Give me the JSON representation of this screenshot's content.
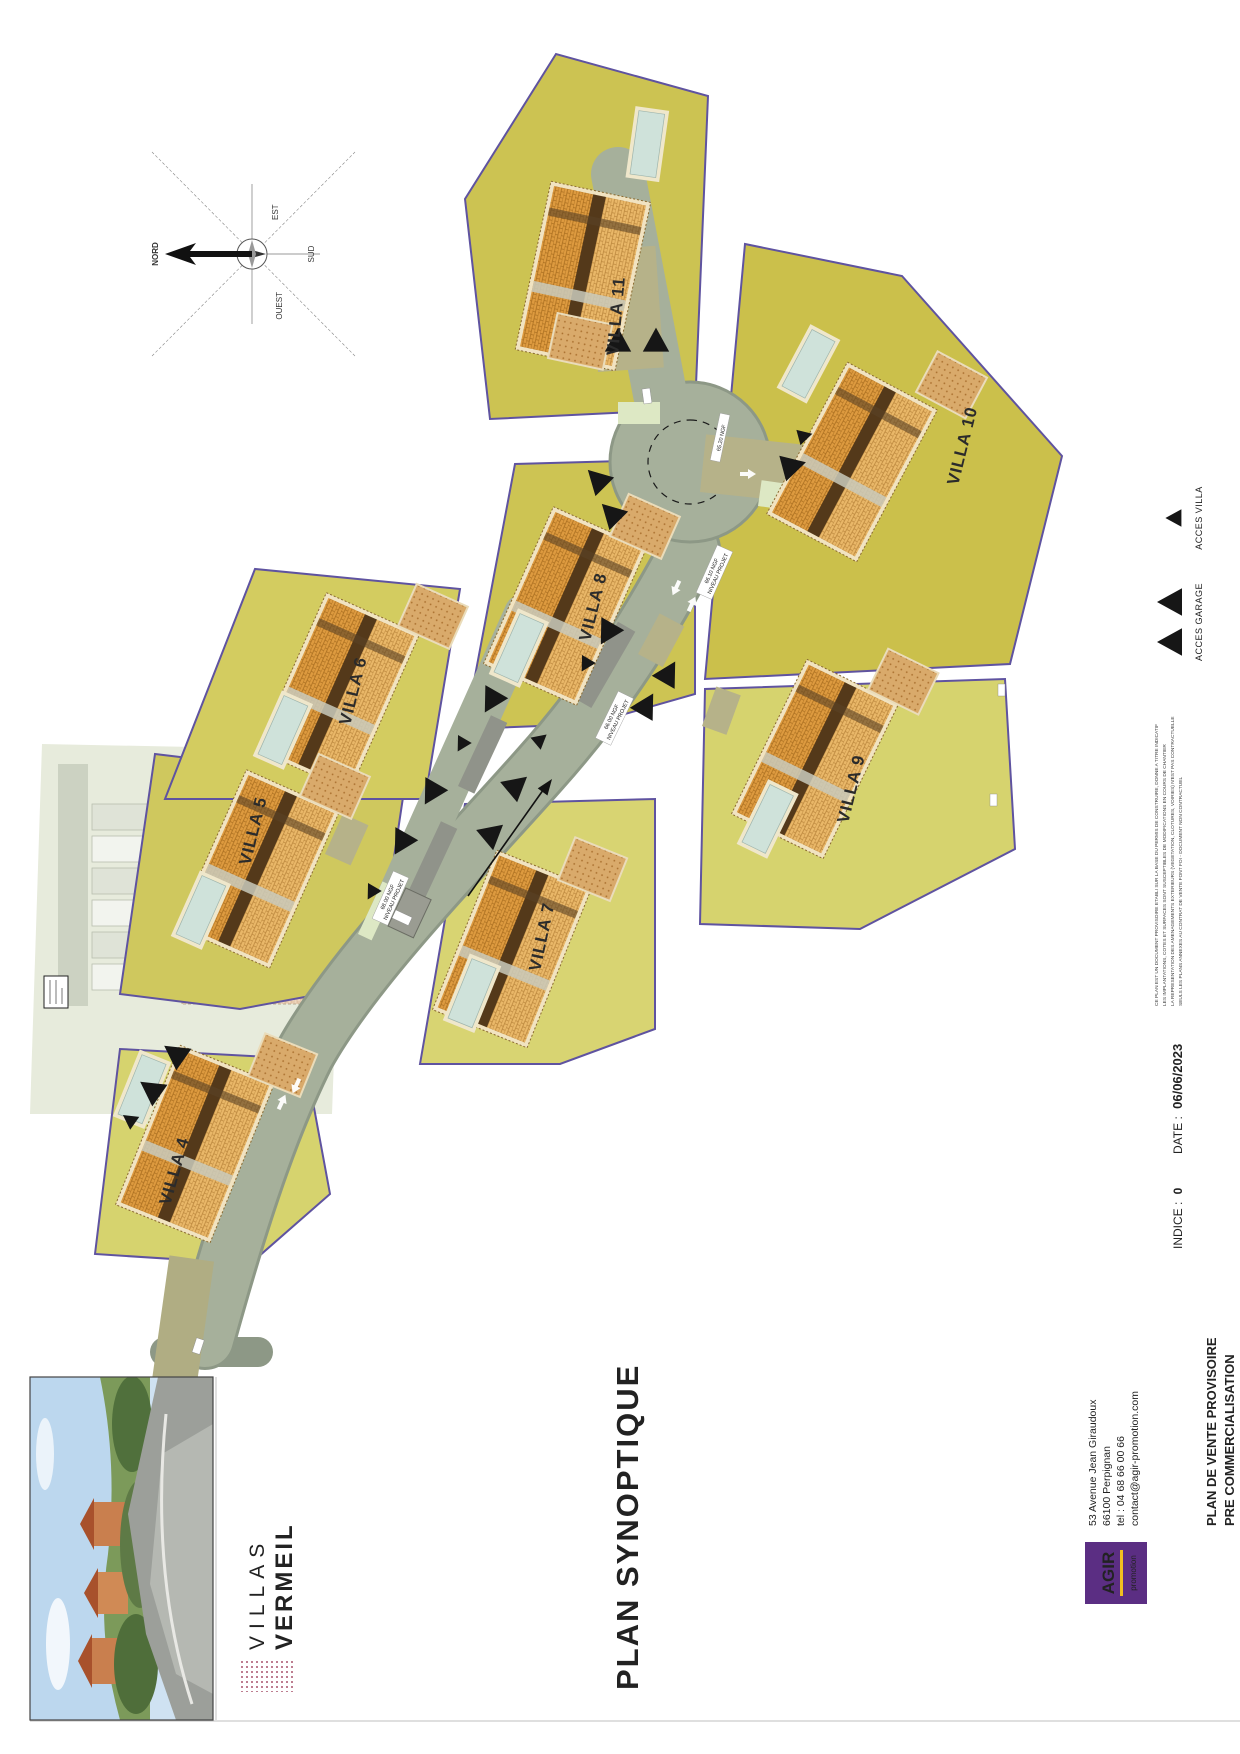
{
  "document": {
    "title": "PLAN SYNOPTIQUE"
  },
  "brand": {
    "name_top": "VILLAS",
    "name_bottom": "VERMEIL"
  },
  "plan": {
    "villas": [
      {
        "name": "VILLA 4"
      },
      {
        "name": "VILLA 5"
      },
      {
        "name": "VILLA 6"
      },
      {
        "name": "VILLA 7"
      },
      {
        "name": "VILLA 8"
      },
      {
        "name": "VILLA 9"
      },
      {
        "name": "VILLA 10"
      },
      {
        "name": "VILLA 11"
      }
    ],
    "compass": {
      "north": "NORD",
      "east": "EST",
      "south": "SUD",
      "west": "OUEST"
    },
    "ngf": [
      {
        "l1": "65.20 NGF",
        "l2": ""
      },
      {
        "l1": "66.10 NGF",
        "l2": "NIVEAU PROJET"
      },
      {
        "l1": "66.00 NGF",
        "l2": "NIVEAU PROJET"
      },
      {
        "l1": "68.00 NGF",
        "l2": "NIVEAU PROJET"
      }
    ],
    "legend": {
      "garage": "ACCES GARAGE",
      "villa": "ACCES VILLA"
    },
    "existing_numbers": [
      "1",
      "2",
      "3",
      "4",
      "5",
      "6"
    ]
  },
  "footer": {
    "promoter": {
      "logo_text": "AGIR",
      "logo_sub": "promotion"
    },
    "address": [
      "53 Avenue Jean Giraudoux",
      "66100 Perpignan",
      "tel : 04 68 66 00 66",
      "contact@agir-promotion.com"
    ],
    "doc_line1": "PLAN DE VENTE PROVISOIRE",
    "doc_line2": "PRE COMMERCIALISATION",
    "indice_label": "INDICE :",
    "indice_value": "0",
    "date_label": "DATE :",
    "date_value": "06/06/2023",
    "disclaimer": [
      "CE PLAN EST UN DOCUMENT PROVISOIRE ETABLI SUR LA BASE DU PERMIS DE CONSTRUIRE, DONNE A TITRE INDICATIF",
      "LES IMPLANTATIONS, COTES ET SURFACES SONT SUSCEPTIBLES DE MODIFICATIONS EN COURS DE CHANTIER",
      "LA REPRESENTATION DES AMENAGEMENTS EXTERIEURS (VEGETATION, CLOTURES, VOIRIES) N'EST PAS CONTRACTUELLE",
      "SEULS LES PLANS ANNEXES AU CONTRAT DE VENTE FONT FOI - DOCUMENT NON CONTRACTUEL"
    ]
  },
  "colors": {
    "parcel_green": "#cdc454",
    "border_purple": "#5f53a0",
    "road_grey_green": "#a6b09b",
    "roof_orange": "#dd9a3f",
    "pool_blue": "#cfe2da",
    "brand_maroon": "#8e2040",
    "agir_purple": "#5b2e83"
  }
}
